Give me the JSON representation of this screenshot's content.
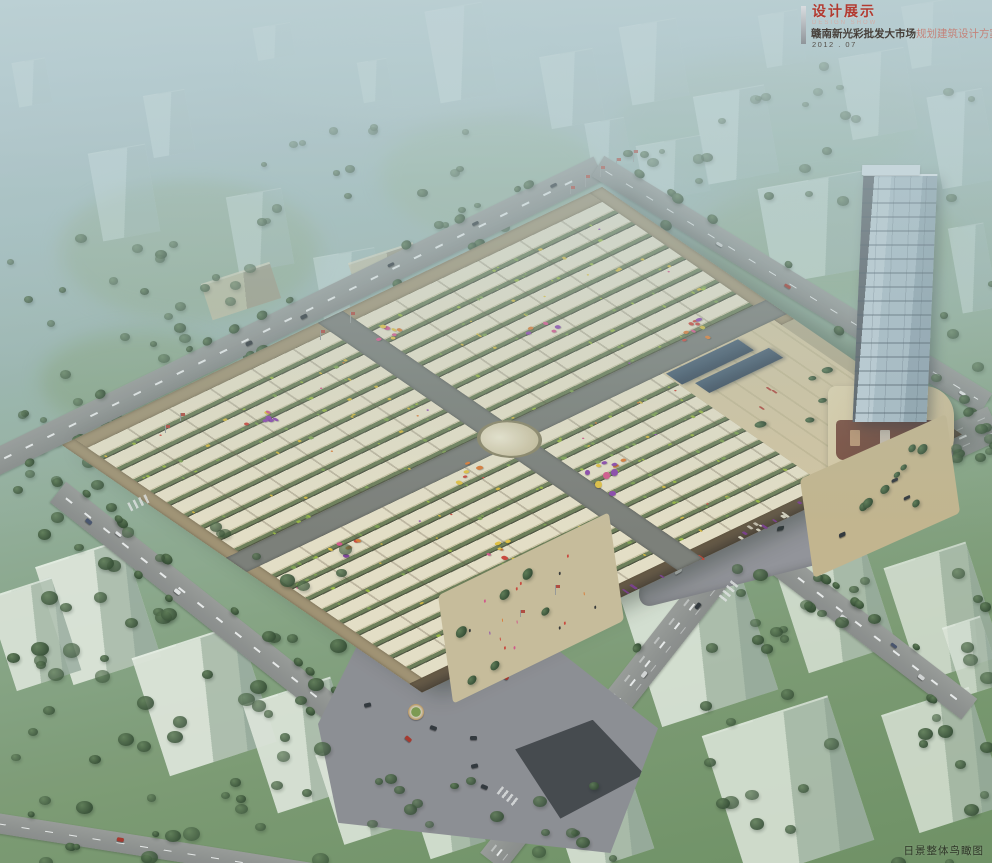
{
  "palette": {
    "title_red": "#b23a30",
    "subtitle_dark": "#463f39",
    "subtitle_red": "#c4837a",
    "date_gray": "#56504a",
    "caption_dark": "#262b20",
    "roof_cream": "#ece3ca",
    "roof_gap_green": "#6d7d55",
    "facade_tan": "#a49372",
    "facade_dark": "#4f4336",
    "road_gray": "#8b8c8a",
    "plaza_gray": "#95949a",
    "asphalt_dark": "#43454a",
    "tower_glass": "#c3d1da",
    "podium_cream": "#d8c7a2",
    "accent_red": "#b5483c",
    "blue_roof": "#3a495b",
    "tree_green": "#3f5b40",
    "haze_blue": "#a9c2c6",
    "balloon_colors": "#d9558a,#d04438,#e8c33f,#8e44ad,#e07b33"
  },
  "title_block": {
    "title": "设计展示",
    "subtitle_en": "DESIGN SHOW",
    "project_name": "赣南新光彩批发大市场",
    "project_suffix": "规划建筑设计方案",
    "date": "2012 . 07"
  },
  "caption": {
    "label": "日景整体鸟瞰图"
  }
}
